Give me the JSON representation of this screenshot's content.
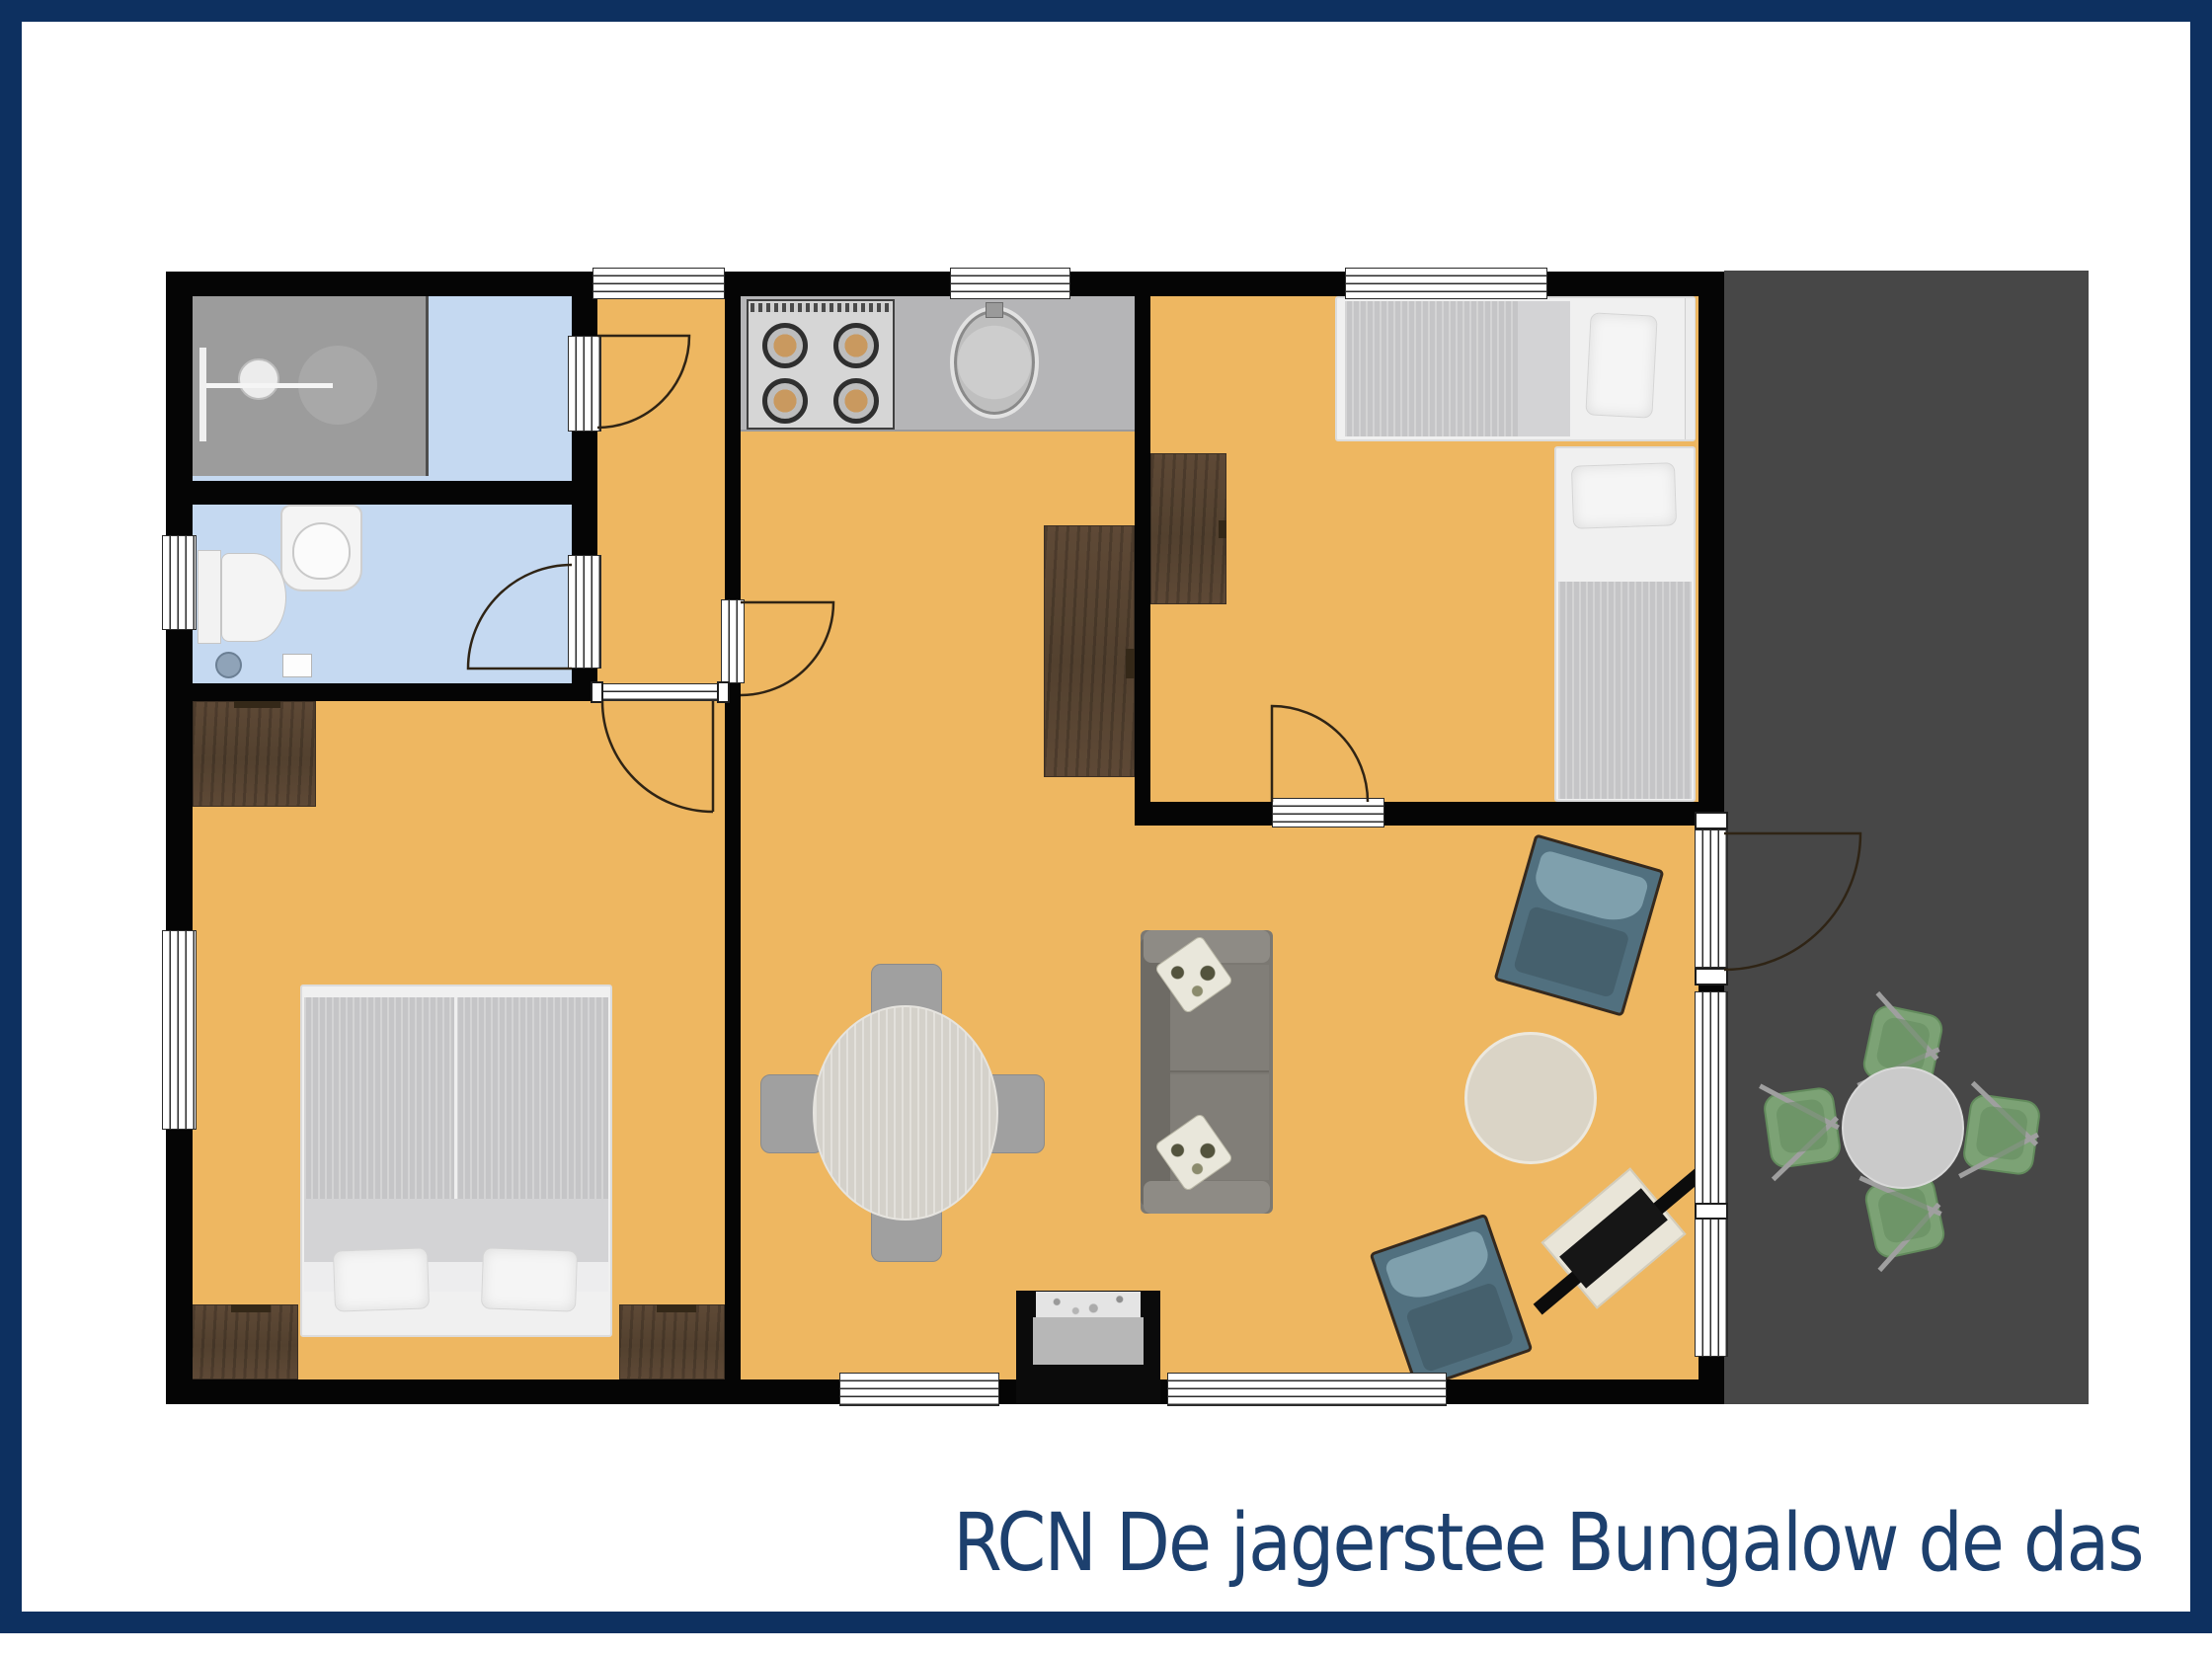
{
  "title": {
    "text": "RCN De jagerstee Bungalow de das"
  },
  "colors": {
    "frame": "#0d3060",
    "title": "#1d406e",
    "floor": "#eeb761",
    "wet": "#c5d9f1",
    "wall": "#050505",
    "terrace": "#474747",
    "counter": "#b5b5b7",
    "stove": "#d6d6d6",
    "burner": "#c9995f",
    "wood": "#5e4936",
    "wood-dark": "#342818",
    "duvet": "#c5c5c7",
    "band": "#d3d3d5",
    "chair": "#a0a0a0",
    "table": "#d4d1ca",
    "coffee": "#dad4c6",
    "sofa": "#7b7872",
    "sofa-arm": "#8e8b85",
    "sofa-back": "#6e6b65",
    "ac": "#51707f",
    "ac-cushion": "#7fa0ad",
    "ac-frame": "#35291e",
    "green": "#7ca275",
    "green-dark": "#628b5c",
    "tv": "#0c0c0c",
    "cream": "#e9e5d8",
    "hearth": "#b7b7b7",
    "shower": "#9c9c9c",
    "door-line": "#2f2415"
  },
  "floorplan": {
    "rooms": [
      "shower-room",
      "toilet-room",
      "hallway",
      "master-bedroom",
      "kitchen",
      "living-dining-room",
      "second-bedroom",
      "terrace"
    ],
    "fixtures": [
      "shower",
      "wash-basin",
      "toilet",
      "stove",
      "kitchen-sink",
      "kitchen-counter",
      "kitchen-cabinet"
    ],
    "furniture": [
      "double-bed",
      "nightstand",
      "nightstand",
      "desk",
      "single-bed",
      "single-bed",
      "desk",
      "dining-table",
      "dining-chair",
      "dining-chair",
      "dining-chair",
      "dining-chair",
      "sofa",
      "coffee-table",
      "armchair",
      "armchair",
      "tv-cabinet",
      "fireplace",
      "terrace-table",
      "terrace-chair",
      "terrace-chair",
      "terrace-chair",
      "terrace-chair"
    ],
    "doors": [
      "front-window",
      "shower-door",
      "toilet-door",
      "master-bedroom-door",
      "kitchen-door",
      "second-bedroom-door",
      "terrace-door"
    ],
    "windows": [
      "toilet-window",
      "master-window",
      "kitchen-window",
      "bedroom-window",
      "living-window-left",
      "living-window-right",
      "terrace-side-window"
    ]
  }
}
